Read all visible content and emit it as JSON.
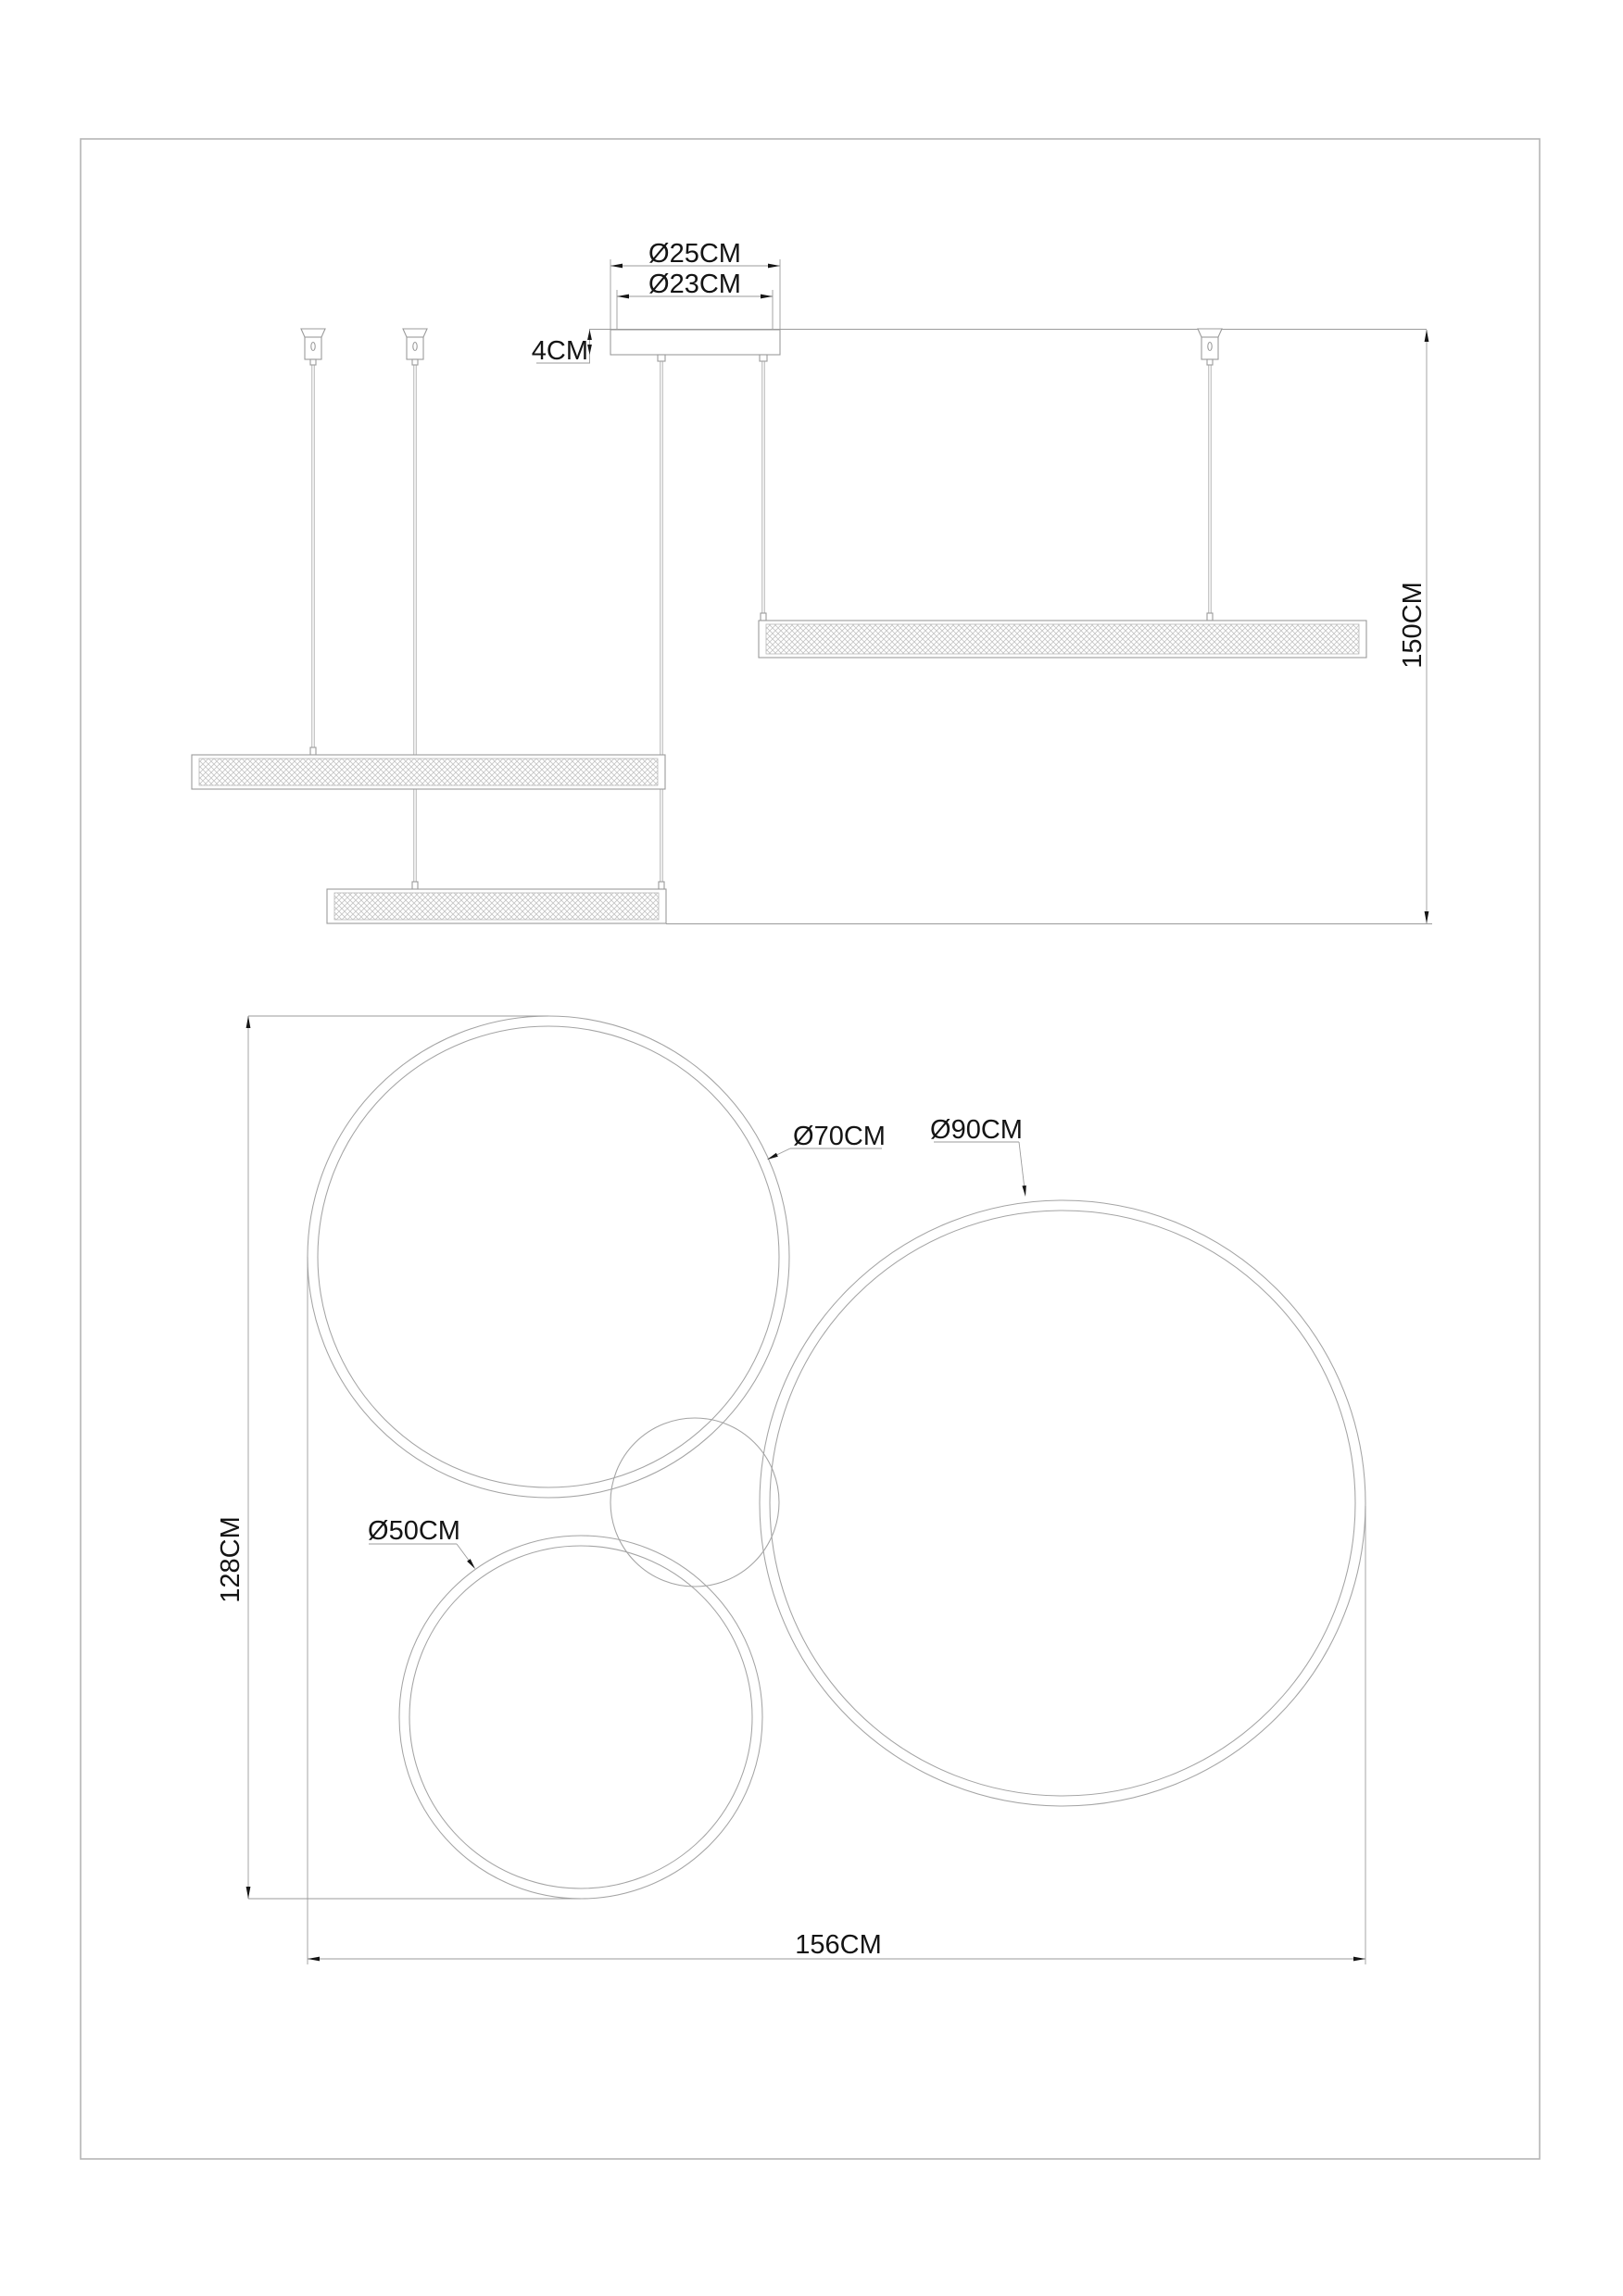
{
  "document": {
    "type": "pendant-lamp-dimension-drawing",
    "views": [
      "side-elevation",
      "plan-top-view"
    ]
  },
  "colors": {
    "line": "#9b9b9b",
    "text": "#141414",
    "border": "#b5b5b5",
    "hatch": "#c4c4c4"
  },
  "side_view": {
    "canopy_diameter_outer": "Ø25CM",
    "canopy_diameter_inner": "Ø23CM",
    "canopy_height": "4CM",
    "suspension_height": "150CM"
  },
  "plan_view": {
    "ring_medium": "Ø70CM",
    "ring_large": "Ø90CM",
    "ring_small": "Ø50CM",
    "overall_depth": "128CM",
    "overall_width": "156CM"
  }
}
